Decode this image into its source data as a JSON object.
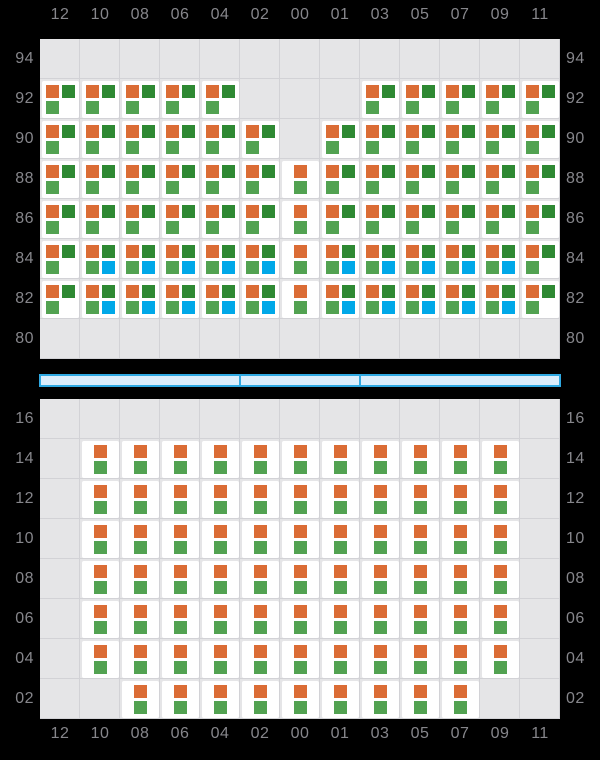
{
  "colors": {
    "background": "#000000",
    "grid_bg": "#e5e5e7",
    "grid_line": "#d2d2d6",
    "tile_bg": "#ffffff",
    "orange": "#db6c35",
    "dark_green": "#2e8933",
    "light_green": "#52a251",
    "blue": "#00a8e8",
    "bar_fill": "#dbedfb",
    "bar_border": "#2fa9e2",
    "axis_label": "#86868b"
  },
  "column_labels": [
    "12",
    "10",
    "08",
    "06",
    "04",
    "02",
    "00",
    "01",
    "03",
    "05",
    "07",
    "09",
    "11"
  ],
  "cell_types": {
    "A": [
      {
        "pos": "tl",
        "color": "orange"
      },
      {
        "pos": "tr",
        "color": "dark_green"
      },
      {
        "pos": "bl",
        "color": "light_green"
      }
    ],
    "B": [
      {
        "pos": "tl",
        "color": "orange"
      },
      {
        "pos": "tr",
        "color": "dark_green"
      },
      {
        "pos": "bl",
        "color": "light_green"
      },
      {
        "pos": "br",
        "color": "blue"
      }
    ],
    "C": [
      {
        "pos": "ct",
        "color": "orange"
      },
      {
        "pos": "cb",
        "color": "light_green"
      }
    ]
  },
  "deck_section": {
    "tier_labels": [
      "94",
      "92",
      "90",
      "88",
      "86",
      "84",
      "82",
      "80"
    ],
    "rows": [
      {
        "tier": "94",
        "cells": [
          "",
          "",
          "",
          "",
          "",
          "",
          "",
          "",
          "",
          "",
          "",
          "",
          ""
        ]
      },
      {
        "tier": "92",
        "cells": [
          "A",
          "A",
          "A",
          "A",
          "A",
          "",
          "",
          "",
          "A",
          "A",
          "A",
          "A",
          "A"
        ]
      },
      {
        "tier": "90",
        "cells": [
          "A",
          "A",
          "A",
          "A",
          "A",
          "A",
          "",
          "A",
          "A",
          "A",
          "A",
          "A",
          "A"
        ]
      },
      {
        "tier": "88",
        "cells": [
          "A",
          "A",
          "A",
          "A",
          "A",
          "A",
          "C",
          "A",
          "A",
          "A",
          "A",
          "A",
          "A"
        ]
      },
      {
        "tier": "86",
        "cells": [
          "A",
          "A",
          "A",
          "A",
          "A",
          "A",
          "C",
          "A",
          "A",
          "A",
          "A",
          "A",
          "A"
        ]
      },
      {
        "tier": "84",
        "cells": [
          "A",
          "B",
          "B",
          "B",
          "B",
          "B",
          "C",
          "B",
          "B",
          "B",
          "B",
          "B",
          "A"
        ]
      },
      {
        "tier": "82",
        "cells": [
          "A",
          "B",
          "B",
          "B",
          "B",
          "B",
          "C",
          "B",
          "B",
          "B",
          "B",
          "B",
          "A"
        ]
      },
      {
        "tier": "80",
        "cells": [
          "",
          "",
          "",
          "",
          "",
          "",
          "",
          "",
          "",
          "",
          "",
          "",
          ""
        ]
      }
    ]
  },
  "hatch_cover": {
    "segment_widths": [
      200,
      120,
      200
    ]
  },
  "hold_section": {
    "tier_labels": [
      "16",
      "14",
      "12",
      "10",
      "08",
      "06",
      "04",
      "02"
    ],
    "rows": [
      {
        "tier": "16",
        "cells": [
          "",
          "",
          "",
          "",
          "",
          "",
          "",
          "",
          "",
          "",
          "",
          "",
          ""
        ]
      },
      {
        "tier": "14",
        "cells": [
          "",
          "C",
          "C",
          "C",
          "C",
          "C",
          "C",
          "C",
          "C",
          "C",
          "C",
          "C",
          ""
        ]
      },
      {
        "tier": "12",
        "cells": [
          "",
          "C",
          "C",
          "C",
          "C",
          "C",
          "C",
          "C",
          "C",
          "C",
          "C",
          "C",
          ""
        ]
      },
      {
        "tier": "10",
        "cells": [
          "",
          "C",
          "C",
          "C",
          "C",
          "C",
          "C",
          "C",
          "C",
          "C",
          "C",
          "C",
          ""
        ]
      },
      {
        "tier": "08",
        "cells": [
          "",
          "C",
          "C",
          "C",
          "C",
          "C",
          "C",
          "C",
          "C",
          "C",
          "C",
          "C",
          ""
        ]
      },
      {
        "tier": "06",
        "cells": [
          "",
          "C",
          "C",
          "C",
          "C",
          "C",
          "C",
          "C",
          "C",
          "C",
          "C",
          "C",
          ""
        ]
      },
      {
        "tier": "04",
        "cells": [
          "",
          "C",
          "C",
          "C",
          "C",
          "C",
          "C",
          "C",
          "C",
          "C",
          "C",
          "C",
          ""
        ]
      },
      {
        "tier": "02",
        "cells": [
          "",
          "",
          "C",
          "C",
          "C",
          "C",
          "C",
          "C",
          "C",
          "C",
          "C",
          "",
          ""
        ]
      }
    ]
  }
}
